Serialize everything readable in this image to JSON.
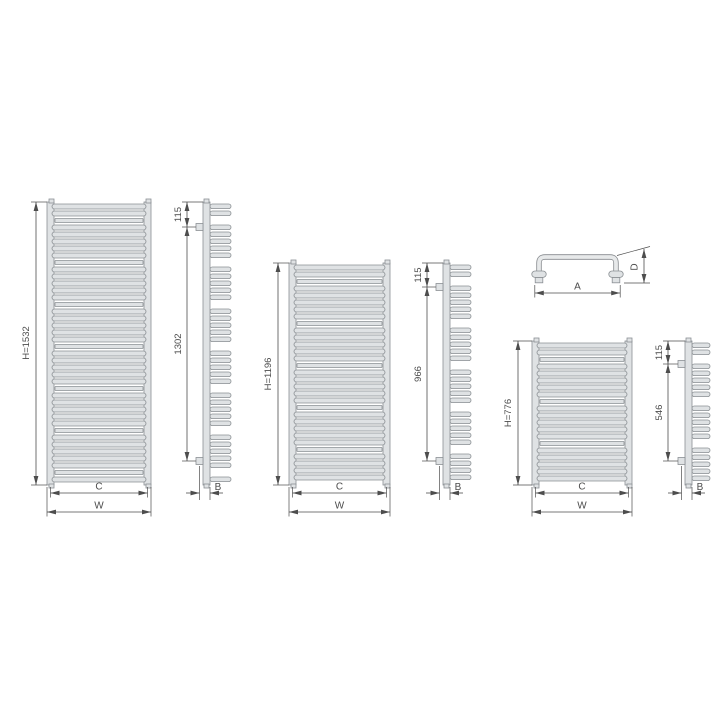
{
  "diagram_title": "heated-towel-radiator-dimension-drawing",
  "colors": {
    "background": "#ffffff",
    "part_fill": "#dfe2e4",
    "part_stroke": "#8b9094",
    "dimension_line": "#4d4d4d",
    "text": "#4c4c4c"
  },
  "radiators": [
    {
      "front": {
        "height": "H=1532",
        "inner_width": "C",
        "overall_width": "W"
      },
      "side": {
        "bracket_top_offset": "115",
        "bracket_span": "1302",
        "depth": "B"
      }
    },
    {
      "front": {
        "height": "H=1196",
        "inner_width": "C",
        "overall_width": "W"
      },
      "side": {
        "bracket_top_offset": "115",
        "bracket_span": "966",
        "depth": "B"
      }
    },
    {
      "front": {
        "height": "H=776",
        "inner_width": "C",
        "overall_width": "W"
      },
      "side": {
        "bracket_top_offset": "115",
        "bracket_span": "546",
        "depth": "B"
      }
    }
  ],
  "handle": {
    "width": "A",
    "depth": "D"
  }
}
